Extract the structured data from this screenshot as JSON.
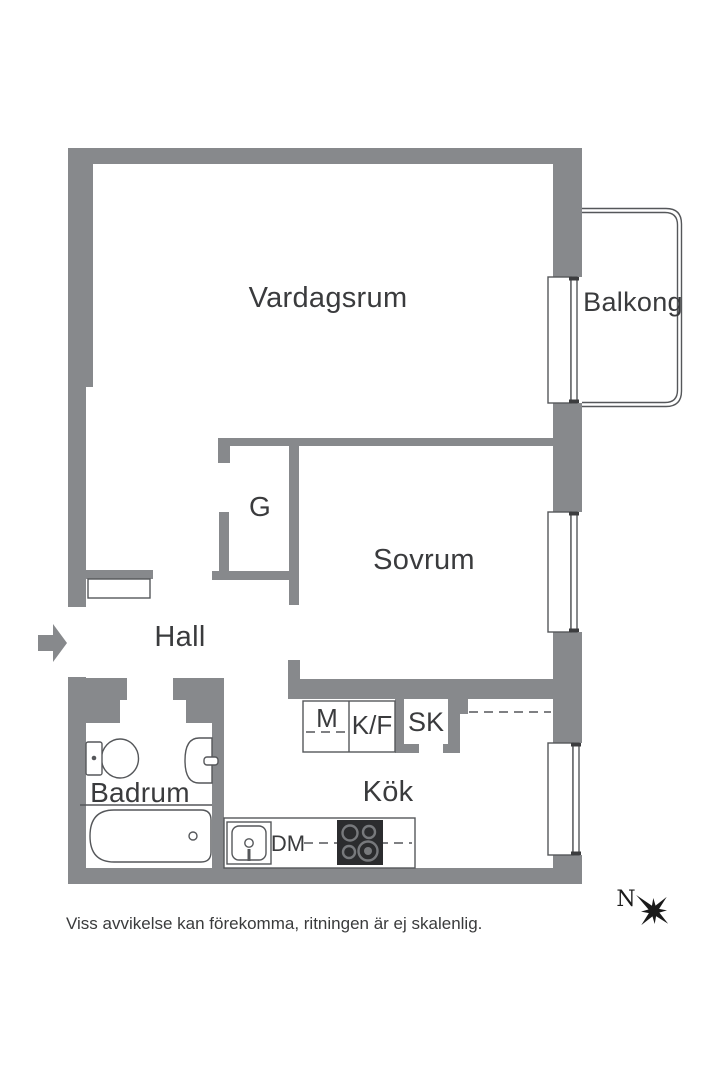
{
  "fp": {
    "rooms": {
      "vardagsrum": "Vardagsrum",
      "balkong": "Balkong",
      "sovrum": "Sovrum",
      "garderob": "G",
      "hall": "Hall",
      "badrum": "Badrum",
      "kok": "Kök"
    },
    "appliances": {
      "m": "M",
      "kf": "K/F",
      "sk": "SK",
      "dm": "DM"
    },
    "compass_north": "N",
    "disclaimer": "Viss avvikelse kan förekomma, ritningen är ej skalenlig.",
    "colors": {
      "wall": "#87898C",
      "outline": "#55575A",
      "label_text": "#3A3B3D",
      "stove": "#2B2C2E",
      "background": "#FFFFFF"
    }
  }
}
